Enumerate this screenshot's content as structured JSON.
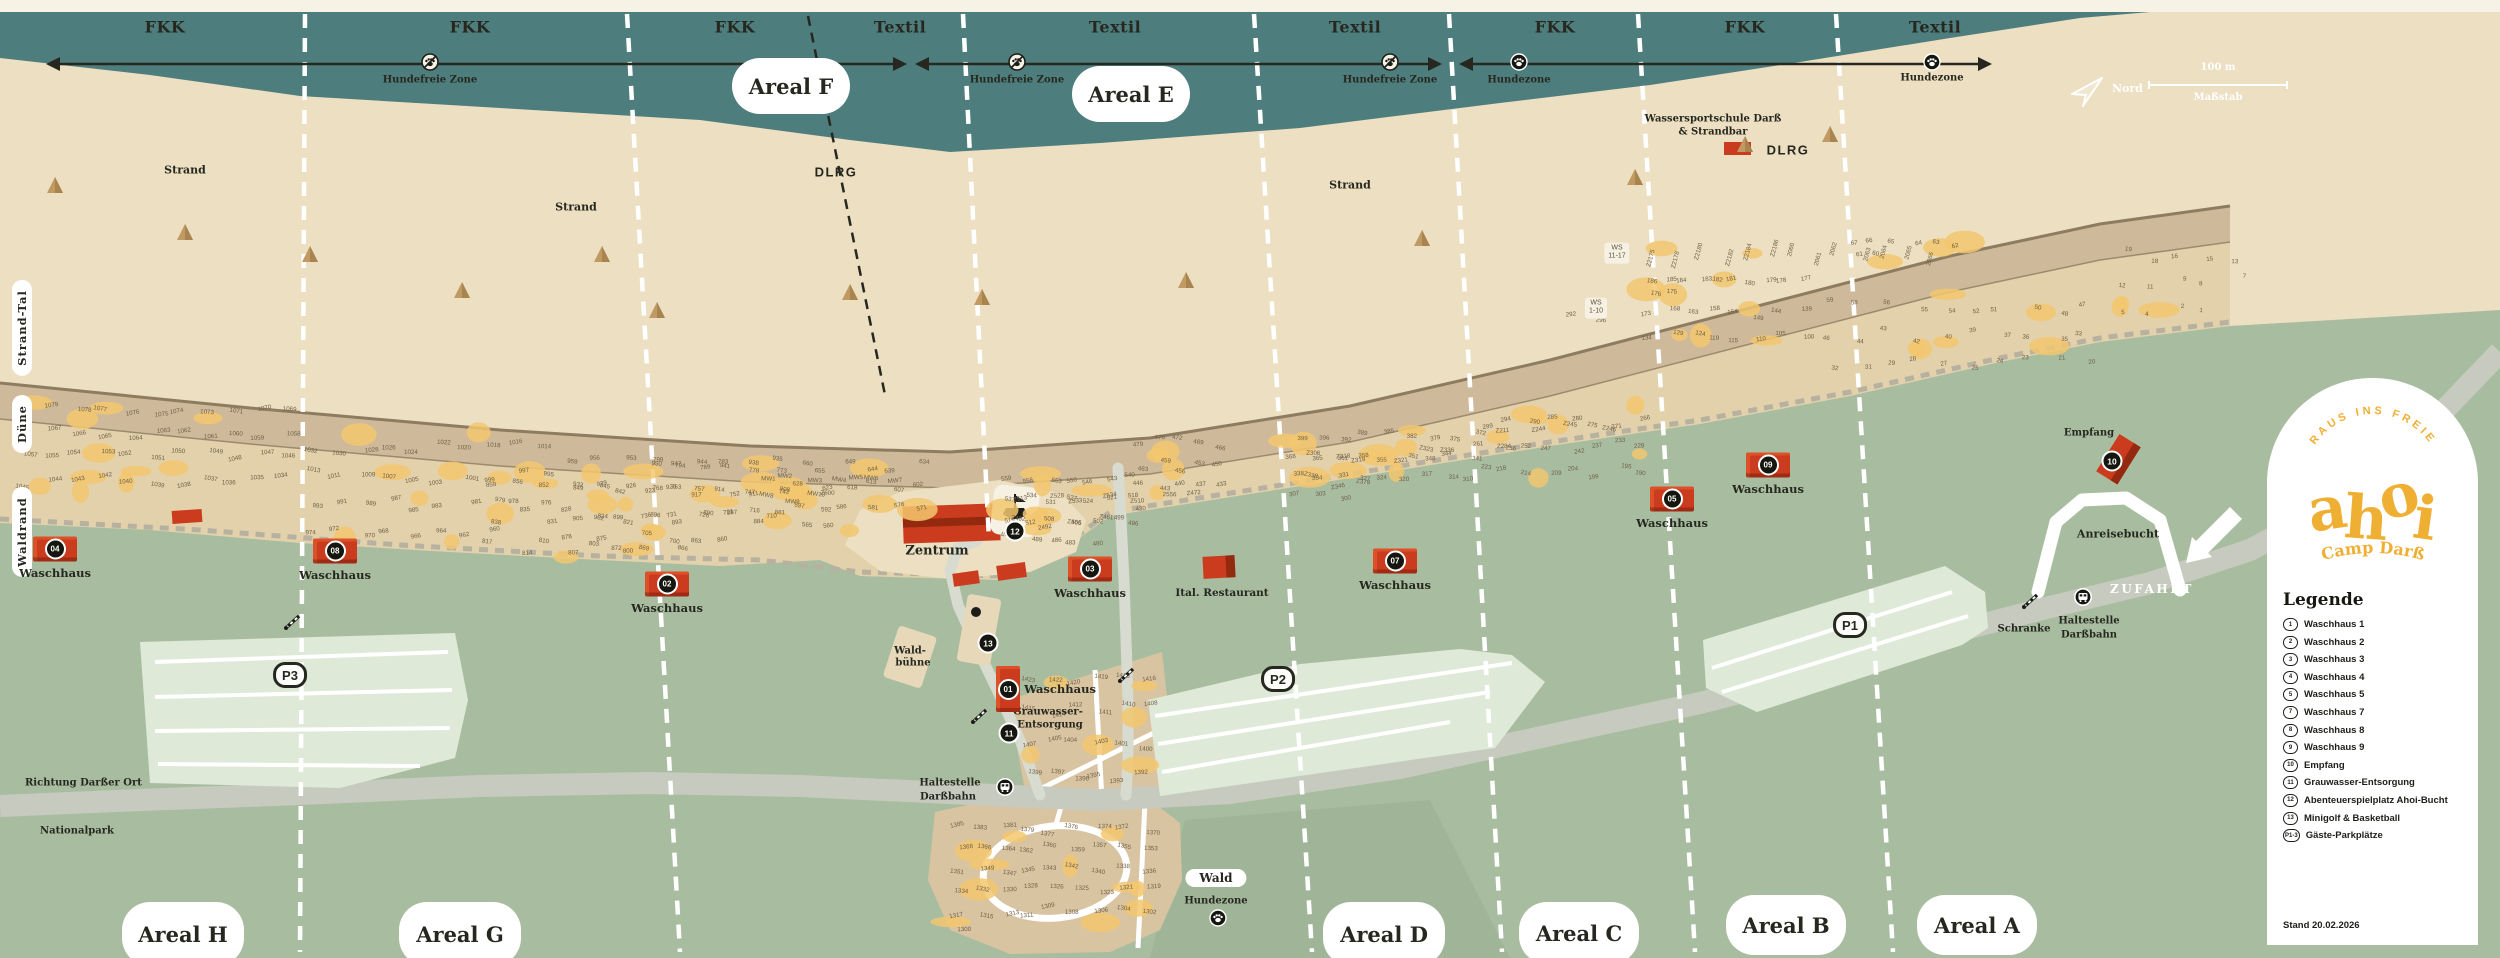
{
  "colors": {
    "sea": "#4e7d7d",
    "paper": "#f6f2e6",
    "beach": "#ecdfc2",
    "band": "#e3d1ab",
    "strip": "#c7b295",
    "bandline": "#8d7c60",
    "green": "#a8bda0",
    "park": "#dfe9d8",
    "road": "#c7cbbf",
    "roadLight": "#d8dbd0",
    "camp": "#d9c4a2",
    "red": "#cb3c1e",
    "redDark": "#93290f",
    "ink": "#26281f",
    "yellow": "#f2c76e",
    "numBrown": "#6f5f45",
    "logoYellow": "#efaf33",
    "white": "#ffffff"
  },
  "top_zones": [
    {
      "label": "FKK",
      "x": 165
    },
    {
      "label": "FKK",
      "x": 470
    },
    {
      "label": "FKK",
      "x": 735
    },
    {
      "label": "Textil",
      "x": 900
    },
    {
      "label": "Textil",
      "x": 1115
    },
    {
      "label": "Textil",
      "x": 1355
    },
    {
      "label": "FKK",
      "x": 1555
    },
    {
      "label": "FKK",
      "x": 1745
    },
    {
      "label": "Textil",
      "x": 1935
    }
  ],
  "area_badges": [
    {
      "label": "Areal F",
      "x": 791,
      "y": 86,
      "w": 118,
      "h": 56
    },
    {
      "label": "Areal E",
      "x": 1131,
      "y": 94,
      "w": 118,
      "h": 56
    },
    {
      "label": "Areal H",
      "x": 183,
      "y": 934,
      "w": 122,
      "h": 64
    },
    {
      "label": "Areal G",
      "x": 460,
      "y": 934,
      "w": 122,
      "h": 64
    },
    {
      "label": "Areal D",
      "x": 1384,
      "y": 934,
      "w": 122,
      "h": 64
    },
    {
      "label": "Areal C",
      "x": 1579,
      "y": 933,
      "w": 120,
      "h": 62
    },
    {
      "label": "Areal B",
      "x": 1786,
      "y": 925,
      "w": 120,
      "h": 60
    },
    {
      "label": "Areal A",
      "x": 1977,
      "y": 925,
      "w": 120,
      "h": 60
    }
  ],
  "vertical_labels": [
    {
      "text": "Strand-Tal",
      "x": 22,
      "y": 328
    },
    {
      "text": "Düne",
      "x": 22,
      "y": 424
    },
    {
      "text": "Waldrand",
      "x": 22,
      "y": 532
    }
  ],
  "labels": [
    {
      "t": "Strand",
      "x": 185,
      "y": 170,
      "fs": 11
    },
    {
      "t": "Strand",
      "x": 576,
      "y": 207,
      "fs": 11
    },
    {
      "t": "Strand",
      "x": 1350,
      "y": 185,
      "fs": 11
    },
    {
      "t": "Hundefreie Zone",
      "x": 430,
      "y": 80,
      "fs": 10
    },
    {
      "t": "Hundefreie Zone",
      "x": 1017,
      "y": 80,
      "fs": 10
    },
    {
      "t": "Hundefreie Zone",
      "x": 1390,
      "y": 80,
      "fs": 10
    },
    {
      "t": "Hundezone",
      "x": 1519,
      "y": 80,
      "fs": 10
    },
    {
      "t": "Hundezone",
      "x": 1932,
      "y": 78,
      "fs": 10
    },
    {
      "t": "Wassersportschule Darß",
      "x": 1713,
      "y": 119,
      "fs": 10
    },
    {
      "t": "& Strandbar",
      "x": 1713,
      "y": 132,
      "fs": 10
    },
    {
      "t": "DLRG",
      "x": 836,
      "y": 172,
      "cls": "dlrg"
    },
    {
      "t": "DLRG",
      "x": 1788,
      "y": 150,
      "cls": "dlrg"
    },
    {
      "t": "Zentrum",
      "x": 937,
      "y": 551,
      "fs": 13
    },
    {
      "t": "Wald-",
      "x": 910,
      "y": 651,
      "fs": 10
    },
    {
      "t": "bühne",
      "x": 913,
      "y": 663,
      "fs": 10
    },
    {
      "t": "Ital. Restaurant",
      "x": 1222,
      "y": 593,
      "fs": 10.5
    },
    {
      "t": "Grauwasser-",
      "x": 1048,
      "y": 712,
      "fs": 10
    },
    {
      "t": "Entsorgung",
      "x": 1050,
      "y": 725,
      "fs": 10
    },
    {
      "t": "Haltestelle",
      "x": 950,
      "y": 783,
      "fs": 10
    },
    {
      "t": "Darßbahn",
      "x": 948,
      "y": 797,
      "fs": 10
    },
    {
      "t": "Haltestelle",
      "x": 2089,
      "y": 621,
      "fs": 10
    },
    {
      "t": "Darßbahn",
      "x": 2089,
      "y": 635,
      "fs": 10
    },
    {
      "t": "Schranke",
      "x": 2024,
      "y": 629,
      "fs": 10
    },
    {
      "t": "Anreisebucht",
      "x": 2118,
      "y": 534,
      "fs": 11
    },
    {
      "t": "Empfang",
      "x": 2089,
      "y": 433,
      "fs": 10
    },
    {
      "t": "ZUFAHRT",
      "x": 2152,
      "y": 589,
      "cls": "zufahrt"
    },
    {
      "t": "Richtung Darßer Ort",
      "x": 25,
      "y": 783,
      "fs": 10,
      "align": "l"
    },
    {
      "t": "Nationalpark",
      "x": 40,
      "y": 831,
      "fs": 10,
      "align": "l"
    },
    {
      "t": "Hundezone",
      "x": 1216,
      "y": 901,
      "fs": 10
    }
  ],
  "wald_badge": {
    "pill": "Wald",
    "x": 1216,
    "y": 878
  },
  "waschhaus_label": "Waschhaus",
  "waschhaus_markers": [
    {
      "num": "04",
      "x": 55,
      "y": 549
    },
    {
      "num": "08",
      "x": 335,
      "y": 551
    },
    {
      "num": "02",
      "x": 667,
      "y": 584
    },
    {
      "num": "03",
      "x": 1090,
      "y": 569
    },
    {
      "num": "07",
      "x": 1395,
      "y": 561
    },
    {
      "num": "05",
      "x": 1672,
      "y": 499
    },
    {
      "num": "09",
      "x": 1768,
      "y": 465
    },
    {
      "num": "01",
      "x": 1008,
      "y": 689,
      "vert": true,
      "side": "right"
    }
  ],
  "poi_markers": [
    {
      "num": "10",
      "x": 2112,
      "y": 461
    },
    {
      "num": "11",
      "x": 1009,
      "y": 733
    },
    {
      "num": "12",
      "x": 1015,
      "y": 531
    },
    {
      "num": "13",
      "x": 988,
      "y": 643
    }
  ],
  "bus_stops": [
    {
      "x": 1005,
      "y": 789
    },
    {
      "x": 2083,
      "y": 599
    }
  ],
  "barriers": [
    {
      "x": 293,
      "y": 624
    },
    {
      "x": 980,
      "y": 718
    },
    {
      "x": 1127,
      "y": 677
    },
    {
      "x": 2031,
      "y": 603
    }
  ],
  "paw_markers": [
    {
      "x": 1218,
      "y": 920
    }
  ],
  "line_markers": [
    {
      "type": "nodog",
      "x": 430,
      "y": 64
    },
    {
      "type": "nodog",
      "x": 1017,
      "y": 64
    },
    {
      "type": "nodog",
      "x": 1390,
      "y": 64
    },
    {
      "type": "dog",
      "x": 1519,
      "y": 64
    },
    {
      "type": "dog",
      "x": 1932,
      "y": 64
    }
  ],
  "p_badges": [
    {
      "label": "P1",
      "x": 1850,
      "y": 625
    },
    {
      "label": "P2",
      "x": 1278,
      "y": 679
    },
    {
      "label": "P3",
      "x": 290,
      "y": 675
    }
  ],
  "ws_boxes": [
    {
      "l1": "WS",
      "l2": "11-17",
      "x": 1617,
      "y": 253
    },
    {
      "l1": "WS",
      "l2": "1-10",
      "x": 1596,
      "y": 308
    }
  ],
  "trees": [
    [
      55,
      193
    ],
    [
      185,
      240
    ],
    [
      310,
      262
    ],
    [
      462,
      298
    ],
    [
      602,
      262
    ],
    [
      657,
      318
    ],
    [
      850,
      300
    ],
    [
      982,
      305
    ],
    [
      1186,
      288
    ],
    [
      1422,
      246
    ],
    [
      1635,
      185
    ],
    [
      1745,
      152
    ],
    [
      1830,
      142
    ]
  ],
  "compass": {
    "north_label": "Nord",
    "scale_label": "100 m",
    "scale_caption": "Maßstab"
  },
  "logo": {
    "arc_text": "RAUS INS FREIE",
    "name": "ahoi",
    "subtitle": "Camp Darß"
  },
  "legend": {
    "title": "Legende",
    "items": [
      {
        "mark": "1",
        "label": "Waschhaus 1"
      },
      {
        "mark": "2",
        "label": "Waschhaus 2"
      },
      {
        "mark": "3",
        "label": "Waschhaus 3"
      },
      {
        "mark": "4",
        "label": "Waschhaus 4"
      },
      {
        "mark": "5",
        "label": "Waschhaus 5"
      },
      {
        "mark": "7",
        "label": "Waschhaus 7"
      },
      {
        "mark": "8",
        "label": "Waschhaus 8"
      },
      {
        "mark": "9",
        "label": "Waschhaus 9"
      },
      {
        "mark": "10",
        "label": "Empfang"
      },
      {
        "mark": "11",
        "label": "Grauwasser-Entsorgung"
      },
      {
        "mark": "12",
        "label": "Abenteuerspielplatz Ahoi-Bucht"
      },
      {
        "mark": "13",
        "label": "Minigolf & Basketball"
      },
      {
        "mark": "P1-3",
        "label": "Gäste-Parkplätze"
      }
    ],
    "stand": "Stand 20.02.2026"
  },
  "pitch_clusters": [
    {
      "x": 15,
      "y": 395,
      "w": 285,
      "h": 120,
      "n": 45,
      "a": 1033,
      "b": 1080
    },
    {
      "x": 300,
      "y": 430,
      "w": 260,
      "h": 115,
      "n": 38,
      "a": 960,
      "b": 1032
    },
    {
      "x": 560,
      "y": 448,
      "w": 230,
      "h": 105,
      "n": 34,
      "a": 860,
      "b": 959
    },
    {
      "x": 480,
      "y": 468,
      "w": 160,
      "h": 90,
      "n": 18,
      "a": 800,
      "b": 859
    },
    {
      "x": 640,
      "y": 452,
      "w": 150,
      "h": 95,
      "n": 20,
      "a": 700,
      "b": 799
    },
    {
      "x": 790,
      "y": 455,
      "w": 140,
      "h": 80,
      "n": 20,
      "a": 560,
      "b": 660
    },
    {
      "x": 1000,
      "y": 468,
      "w": 145,
      "h": 80,
      "n": 26,
      "a": 480,
      "b": 559
    },
    {
      "x": 1130,
      "y": 430,
      "w": 100,
      "h": 90,
      "n": 16,
      "a": 430,
      "b": 479
    },
    {
      "x": 1285,
      "y": 425,
      "w": 200,
      "h": 82,
      "n": 30,
      "a": 300,
      "b": 399
    },
    {
      "x": 1470,
      "y": 405,
      "w": 185,
      "h": 78,
      "n": 24,
      "a": 190,
      "b": 299
    },
    {
      "x": 1640,
      "y": 300,
      "w": 175,
      "h": 45,
      "n": 16,
      "a": 100,
      "b": 173
    },
    {
      "x": 1645,
      "y": 275,
      "w": 165,
      "h": 22,
      "n": 12,
      "a": 175,
      "b": 186
    },
    {
      "x": 1845,
      "y": 235,
      "w": 120,
      "h": 28,
      "n": 8,
      "a": 60,
      "b": 67
    },
    {
      "x": 1820,
      "y": 290,
      "w": 280,
      "h": 85,
      "n": 30,
      "a": 20,
      "b": 59
    },
    {
      "x": 2110,
      "y": 240,
      "w": 140,
      "h": 80,
      "n": 14,
      "a": 1,
      "b": 19
    },
    {
      "x": 1645,
      "y": 238,
      "w": 300,
      "h": 26,
      "rot": -75,
      "list": [
        "Z2175",
        "Z2178",
        "Z2180",
        "Z2182",
        "Z2184",
        "Z2186",
        "2060",
        "2061",
        "2062",
        "2063",
        "2064",
        "2065",
        "2066"
      ]
    },
    {
      "x": 758,
      "y": 468,
      "w": 150,
      "h": 38,
      "list": [
        "MW1",
        "MW2",
        "MW3",
        "MW4",
        "MW5",
        "MW6",
        "MW7",
        "MW8",
        "MW9",
        "MW10",
        "Z600"
      ]
    },
    {
      "x": 1010,
      "y": 478,
      "w": 200,
      "h": 58,
      "list": [
        "Z513",
        "Z528",
        "Z533",
        "Z534",
        "Z510",
        "2556",
        "Z472",
        "Z492",
        "2492",
        "Z466",
        "Z461"
      ]
    },
    {
      "x": 1290,
      "y": 438,
      "w": 180,
      "h": 55,
      "list": [
        "Z306",
        "Z318",
        "Z319",
        "Z321",
        "Z323",
        "Z336",
        "Z338",
        "Z346",
        "Z379"
      ]
    },
    {
      "x": 1475,
      "y": 412,
      "w": 150,
      "h": 50,
      "list": [
        "Z211",
        "Z244",
        "Z245",
        "Z246",
        "Z284"
      ]
    },
    {
      "x": 1565,
      "y": 295,
      "w": 40,
      "h": 40,
      "list": [
        "292",
        "296"
      ]
    },
    {
      "x": 948,
      "y": 818,
      "w": 212,
      "h": 122,
      "n": 46,
      "a": 1300,
      "b": 1385
    },
    {
      "x": 1018,
      "y": 660,
      "w": 140,
      "h": 128,
      "n": 24,
      "a": 1392,
      "b": 1423
    }
  ]
}
